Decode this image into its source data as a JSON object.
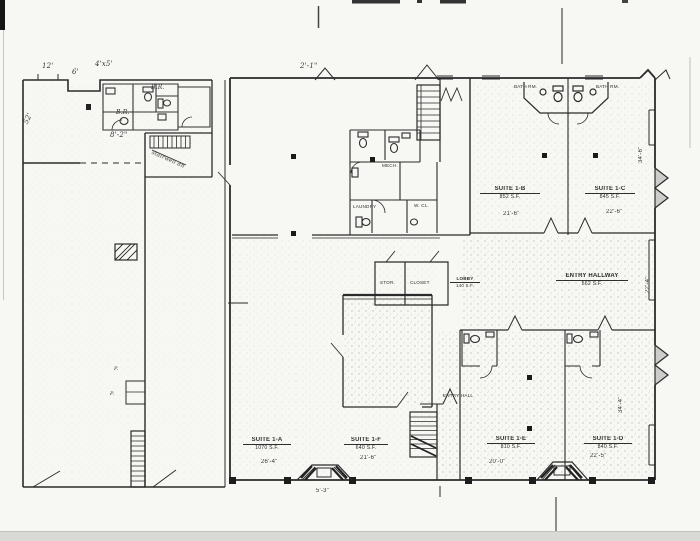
{
  "document": {
    "kind": "scanned floor plan",
    "ink_color": "#2b2b2b",
    "paper_color": "#f7f7f4"
  },
  "plan": {
    "suites": [
      {
        "name": "SUITE 1-B",
        "area": "852 S.F."
      },
      {
        "name": "SUITE 1-C",
        "area": "845 S.F."
      },
      {
        "name": "ENTRY HALLWAY",
        "area": "562 S.F."
      },
      {
        "name": "SUITE 1-E",
        "area": "810 S.F."
      },
      {
        "name": "SUITE 1-D",
        "area": "840 S.F."
      },
      {
        "name": "SUITE 1-A",
        "area": "1070 S.F."
      },
      {
        "name": "SUITE 1-F",
        "area": "640 S.F."
      }
    ],
    "rooms": [
      {
        "name": "LOBBY",
        "area": "140 S.F."
      },
      {
        "name": "STOR."
      },
      {
        "name": "CLOSET"
      },
      {
        "name": "MECH."
      },
      {
        "name": "LAUNDRY"
      },
      {
        "name": "W. CL."
      },
      {
        "name": "BATH RM."
      },
      {
        "name": "BATH RM."
      },
      {
        "name": "ENTRY HALL"
      }
    ],
    "dimensions": [
      "21'-6\"",
      "22'-6\"",
      "34'-6\"",
      "22'-4\"",
      "34'-4\"",
      "26'-4\"",
      "21'-6\"",
      "5'-3\"",
      "20'-0\"",
      "22'-5\""
    ],
    "handwritten": {
      "dims": [
        "12'",
        "6'",
        "4'x5'",
        "8'-2\"",
        "52'",
        "2'-1\""
      ],
      "notes": [
        "B.R.",
        "B.R.",
        "P.",
        "P.",
        "stairwell dn"
      ]
    }
  }
}
